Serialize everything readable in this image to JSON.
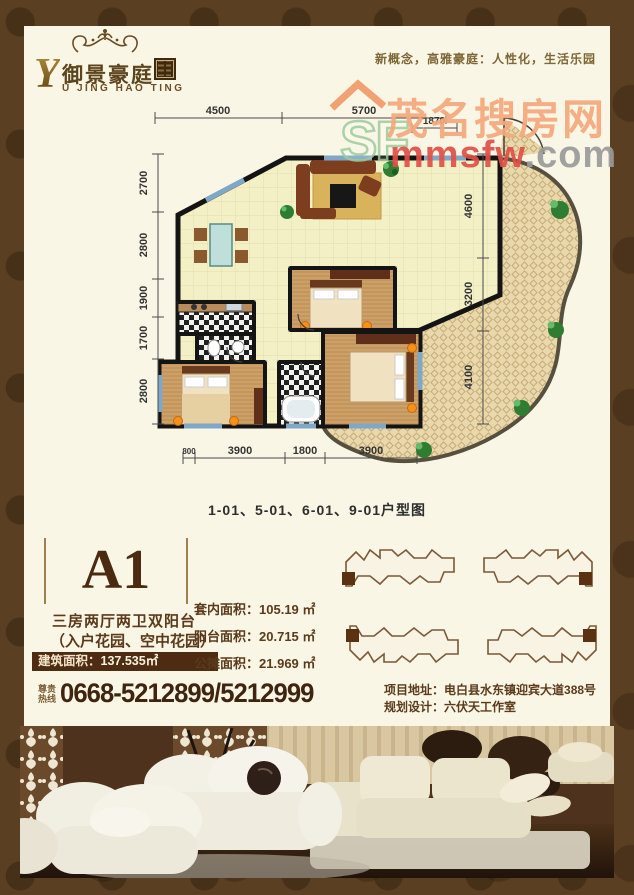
{
  "colors": {
    "frame": "#5a3f22",
    "content_bg": "#faf6e6",
    "accent_dark": "#4a2b12",
    "area_bar_bg": "#4e2c14",
    "watermark_orange": "#f5a87c",
    "watermark_red": "#e25048",
    "watermark_gray": "#9a9a9a",
    "watermark_green": "#9ccc9c"
  },
  "header": {
    "logo_initial": "Y",
    "logo_name_cn": "御景豪庭",
    "logo_name_en": "U JING HAO TING",
    "slogan": "新概念，高雅豪庭：人性化，生活乐园"
  },
  "watermark": {
    "sf": "SF",
    "site_cn": "茂名搜房网",
    "site_en": "mmsfw",
    "site_tld": ".com"
  },
  "floorplan": {
    "caption": "1-01、5-01、6-01、9-01户型图",
    "dims_top": [
      "4500",
      "5700",
      "1870"
    ],
    "dims_left": [
      "2700",
      "2800",
      "1900",
      "1700",
      "2800"
    ],
    "dims_right": [
      "4600",
      "3200",
      "4100"
    ],
    "dims_bottom": [
      "800",
      "3900",
      "1800",
      "3900"
    ]
  },
  "unit": {
    "code": "A1",
    "layout_line1": "三房两厅两卫双阳台",
    "layout_line2": "（入户花园、空中花园）",
    "built_area_label": "建筑面积：",
    "built_area_value": "137.535㎡",
    "areas": [
      {
        "label": "套内面积：",
        "value": "105.19 ㎡"
      },
      {
        "label": "阳台面积：",
        "value": "20.715 ㎡"
      },
      {
        "label": "公摊面积：",
        "value": "21.969 ㎡"
      }
    ]
  },
  "contact": {
    "hotline_label_line1": "尊贵",
    "hotline_label_line2": "热线",
    "hotline_number": "0668-5212899/5212999",
    "address_label": "项目地址：",
    "address_value": "电白县水东镇迎宾大道388号",
    "design_label": "规划设计：",
    "design_value": "六伏天工作室"
  }
}
